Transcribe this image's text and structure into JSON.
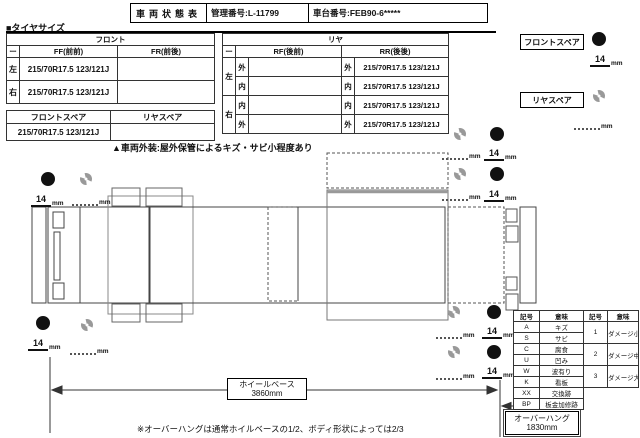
{
  "header": {
    "title": "車両状態表",
    "mgmt_label": "管理番号",
    "mgmt_value": ":L-11799",
    "chassis_label": "車台番号:",
    "chassis_value": "FEB90-6*****"
  },
  "tire_section": {
    "heading": "■タイヤサイズ",
    "front_table": {
      "title": "フロント",
      "col_dash": "ー",
      "col_ff": "FF(前前)",
      "col_fr": "FR(前後)",
      "rows": [
        {
          "side": "左",
          "ff": "215/70R17.5 123/121J",
          "fr": ""
        },
        {
          "side": "右",
          "ff": "215/70R17.5 123/121J",
          "fr": ""
        }
      ]
    },
    "spare_table": {
      "col_front": "フロントスペア",
      "col_rear": "リヤスペア",
      "front_value": "215/70R17.5 123/121J",
      "rear_value": ""
    },
    "rear_table": {
      "title": "リヤ",
      "col_dash": "ー",
      "col_rf": "RF(後前)",
      "col_rr": "RR(後後)",
      "rows": [
        {
          "side": "左",
          "pos": "外",
          "rf": "",
          "rr": "215/70R17.5 123/121J"
        },
        {
          "side": "左",
          "pos": "内",
          "rf": "",
          "rr": "215/70R17.5 123/121J"
        },
        {
          "side": "右",
          "pos": "内",
          "rf": "",
          "rr": "215/70R17.5 123/121J"
        },
        {
          "side": "右",
          "pos": "外",
          "rf": "",
          "rr": "215/70R17.5 123/121J"
        }
      ]
    },
    "front_spare_label": "フロントスペア",
    "rear_spare_label": "リヤスペア"
  },
  "exterior_note": "▲車両外装:屋外保管によるキズ・サビ小程度あり",
  "diagram": {
    "tread_depth": "14",
    "unit": "mm",
    "wheelbase_label": "ホイールベース",
    "wheelbase_value": "3860mm",
    "overhang_label": "オーバーハング",
    "overhang_value": "1830mm"
  },
  "legend": {
    "headers": [
      "記号",
      "意味",
      "記号",
      "意味"
    ],
    "left_rows": [
      {
        "sym": "A",
        "meaning": "キズ"
      },
      {
        "sym": "S",
        "meaning": "サビ"
      },
      {
        "sym": "C",
        "meaning": "腐食"
      },
      {
        "sym": "U",
        "meaning": "凹み"
      },
      {
        "sym": "W",
        "meaning": "波有り"
      },
      {
        "sym": "K",
        "meaning": "看板"
      },
      {
        "sym": "XX",
        "meaning": "交換跡"
      },
      {
        "sym": "BP",
        "meaning": "板金加修跡"
      }
    ],
    "right_rows": [
      {
        "sym": "1",
        "meaning": "ダメージ小"
      },
      {
        "sym": "2",
        "meaning": "ダメージ中"
      },
      {
        "sym": "3",
        "meaning": "ダメージ大"
      }
    ]
  },
  "footnote": "※オーバーハングは通常ホイルベースの1/2、ボディ形状によっては2/3",
  "colors": {
    "ink": "#111111",
    "dashed_wheel": "#999999"
  }
}
